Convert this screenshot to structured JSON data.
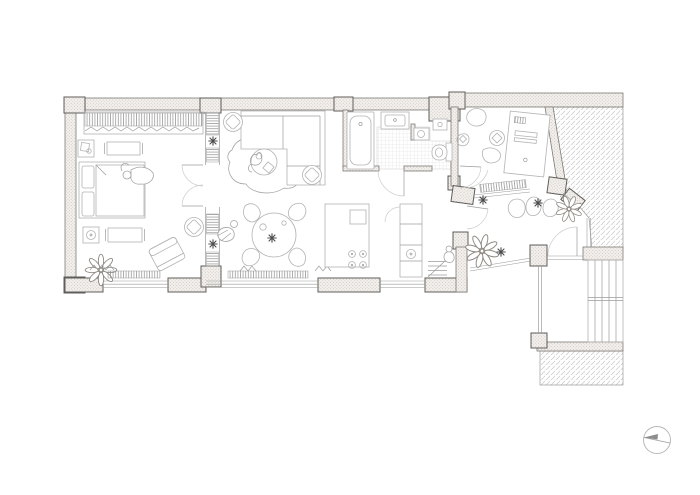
{
  "document": {
    "kind": "architectural floor plan of a small apartment, top-down line drawing on white",
    "background": "#ffffff"
  },
  "palette": {
    "wall_outline": "#7d7a76",
    "pier_outline": "#5f5d5a",
    "wall_fill_base": "#f2efec",
    "wall_fill_dot": "#bcb4ab",
    "furniture_line": "#b3b3b3",
    "detail_line": "#9c9c9c",
    "figure_line": "#a6a6a6",
    "door_arc": "#cccccc",
    "hatch_line": "#c6c6c6",
    "hatch_edge": "#9a9a9a",
    "tile_line": "#d9d9d9",
    "stripe_line": "#8e8e8e",
    "plant_line": "#8f8a83",
    "plant_accent": "#4c4c4c",
    "compass_ring": "#b8b8b8",
    "compass_needle": "#8d8d8d"
  },
  "rooms": [
    {
      "id": "bedroom",
      "furniture": [
        "wardrobe-hanging-clothes",
        "bed",
        "person-on-bed",
        "nightstand",
        "side-table",
        "rug",
        "rug",
        "armchair",
        "pouf",
        "leaf-plant",
        "window-curtain"
      ]
    },
    {
      "id": "shelving-partition",
      "furniture": [
        "shelf-bank",
        "shelf-bank",
        "shelf-bank",
        "shelf-bank",
        "potted-plant",
        "potted-plant",
        "double-swing-doors"
      ]
    },
    {
      "id": "living-room",
      "furniture": [
        "corner-sofa",
        "coffee-table",
        "organic-rug",
        "pouf",
        "pouf",
        "cat",
        "radiator",
        "window-curtain"
      ]
    },
    {
      "id": "dining-area",
      "furniture": [
        "round-table",
        "chair",
        "chair",
        "chair",
        "chair",
        "table-plant",
        "person-seated"
      ]
    },
    {
      "id": "kitchen",
      "furniture": [
        "island-with-hob",
        "tall-counter-with-sink",
        "entry-steps",
        "person-standing"
      ]
    },
    {
      "id": "bathroom",
      "furniture": [
        "bathtub",
        "washbasin",
        "tiled-floor",
        "door-swing",
        "appliance-niche"
      ]
    },
    {
      "id": "wc",
      "furniture": [
        "toilet",
        "corner-basin",
        "tiled-floor"
      ]
    },
    {
      "id": "study",
      "furniture": [
        "desk-with-monitor",
        "desk-chair",
        "beanbag",
        "beanbag-rock",
        "radiator",
        "door-swing"
      ]
    },
    {
      "id": "hallway",
      "furniture": [
        "pebble-stones",
        "leaf-plant",
        "leaf-plant",
        "potted-plant",
        "potted-plant",
        "entry-door-swing",
        "glazed-wall"
      ]
    },
    {
      "id": "stairwell",
      "furniture": [
        "stair-flight",
        "landing"
      ]
    }
  ],
  "exterior": [
    "adjacent-building-hatch-northeast",
    "adjacent-building-hatch-southeast"
  ],
  "compass": {
    "type": "north-arrow",
    "position": "bottom-right"
  }
}
